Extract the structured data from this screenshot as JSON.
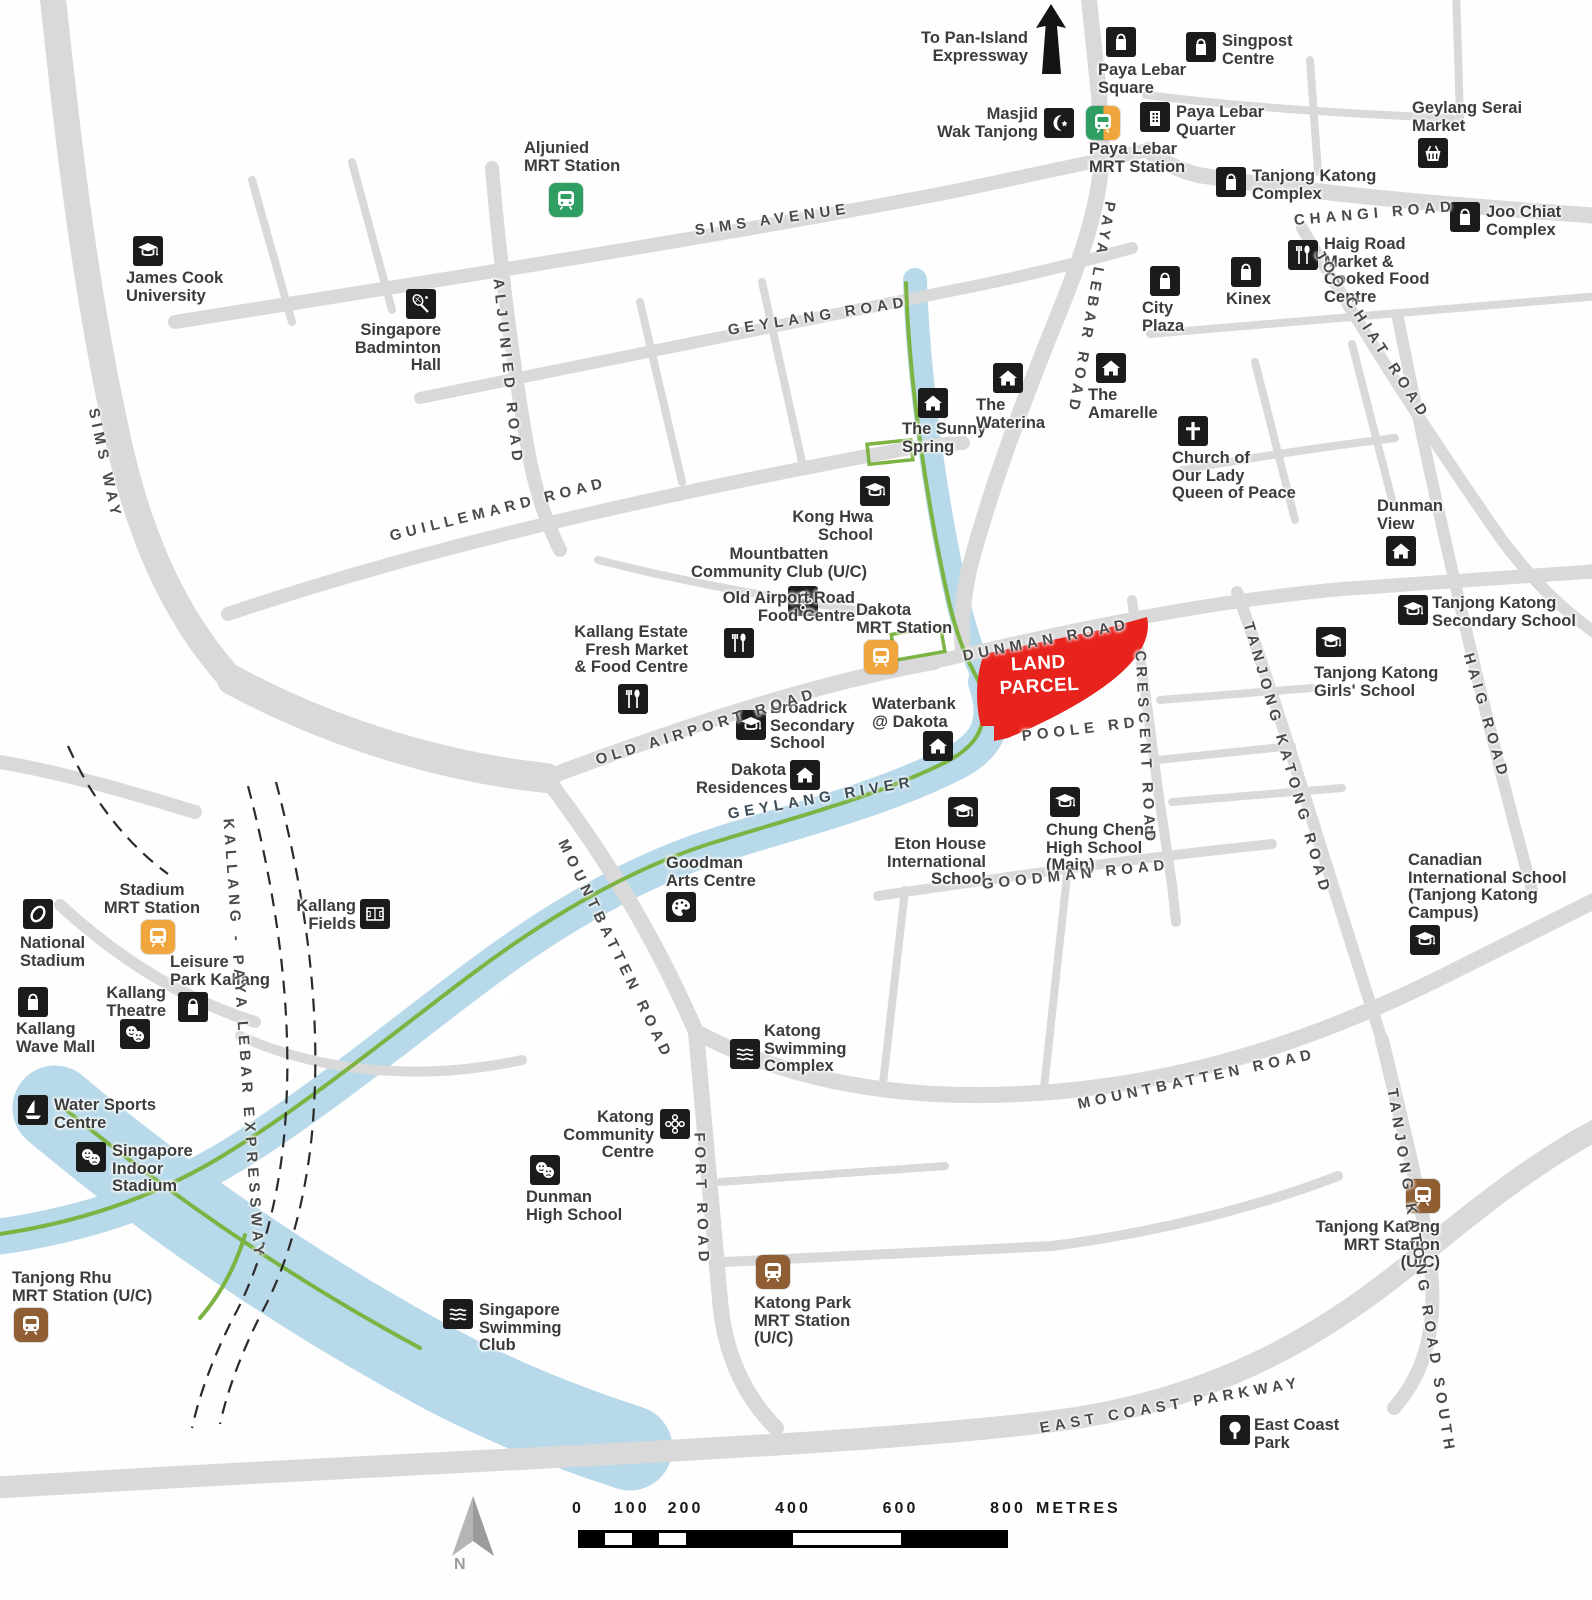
{
  "colors": {
    "road": "#d9d9d9",
    "water": "#b7d9e9",
    "park_connector": "#7cb342",
    "land_parcel": "#e8231d",
    "poi_icon_bg": "#1b1b1b",
    "mrt_yellow": "#f0a63c",
    "mrt_green": "#2f9e62",
    "mrt_brown": "#8f5f33",
    "text": "#3c3c3c"
  },
  "land_parcel": {
    "label": "LAND\nPARCEL"
  },
  "top_note": {
    "label": "To Pan-Island\nExpressway"
  },
  "compass": {
    "label": "N"
  },
  "scale_bar": {
    "ticks": [
      "0",
      "100",
      "200",
      "400",
      "600",
      "800"
    ],
    "metres": [
      0,
      100,
      200,
      400,
      600,
      800
    ],
    "unit": "METRES",
    "max": 800
  },
  "river_label": "GEYLANG RIVER",
  "road_labels": [
    {
      "id": "sims-avenue",
      "t": "SIMS AVENUE",
      "x": 695,
      "y": 222,
      "r": -8
    },
    {
      "id": "geylang-road",
      "t": "GEYLANG ROAD",
      "x": 728,
      "y": 322,
      "r": -9
    },
    {
      "id": "guillemard-road",
      "t": "GUILLEMARD ROAD",
      "x": 390,
      "y": 528,
      "r": -14
    },
    {
      "id": "aljunied-road",
      "t": "ALJUNIED ROAD",
      "x": 498,
      "y": 270,
      "r": 84
    },
    {
      "id": "sims-way",
      "t": "SIMS WAY",
      "x": 93,
      "y": 400,
      "r": 78
    },
    {
      "id": "paya-lebar-road",
      "t": "PAYA LEBAR ROAD",
      "x": 1110,
      "y": 193,
      "r": 100
    },
    {
      "id": "changi-road",
      "t": "CHANGI ROAD",
      "x": 1294,
      "y": 212,
      "r": -5
    },
    {
      "id": "joo-chiat-road",
      "t": "JOO CHIAT ROAD",
      "x": 1318,
      "y": 243,
      "r": 57
    },
    {
      "id": "dunman-road",
      "t": "DUNMAN ROAD",
      "x": 963,
      "y": 648,
      "r": -11
    },
    {
      "id": "old-airport-road",
      "t": "OLD AIRPORT ROAD",
      "x": 596,
      "y": 752,
      "r": -17
    },
    {
      "id": "poole-rd",
      "t": "POOLE RD",
      "x": 1022,
      "y": 728,
      "r": -7
    },
    {
      "id": "crescent-road",
      "t": "CRESCENT ROAD",
      "x": 1140,
      "y": 642,
      "r": 87
    },
    {
      "id": "tanjong-katong-road",
      "t": "TANJONG KATONG ROAD",
      "x": 1248,
      "y": 614,
      "r": 74
    },
    {
      "id": "haig-road",
      "t": "HAIG ROAD",
      "x": 1468,
      "y": 645,
      "r": 74
    },
    {
      "id": "geylang-river",
      "t": "GEYLANG RIVER",
      "x": 728,
      "y": 806,
      "r": -10,
      "river": true
    },
    {
      "id": "goodman-road",
      "t": "GOODMAN ROAD",
      "x": 982,
      "y": 876,
      "r": -6
    },
    {
      "id": "mountbatten-road-upper",
      "t": "MOUNTBATTEN ROAD",
      "x": 562,
      "y": 832,
      "r": 64
    },
    {
      "id": "kallang-paya-lebar-expressway",
      "t": "KALLANG - PAYA LEBAR EXPRESSWAY",
      "x": 228,
      "y": 810,
      "r": 86
    },
    {
      "id": "fort-road",
      "t": "FORT ROAD",
      "x": 699,
      "y": 1124,
      "r": 88
    },
    {
      "id": "mountbatten-road-lower",
      "t": "MOUNTBATTEN ROAD",
      "x": 1078,
      "y": 1096,
      "r": -12
    },
    {
      "id": "tanjong-katong-road-south",
      "t": "TANJONG KATONG ROAD SOUTH",
      "x": 1392,
      "y": 1080,
      "r": 81
    },
    {
      "id": "east-coast-parkway",
      "t": "EAST COAST PARKWAY",
      "x": 1040,
      "y": 1420,
      "r": -10
    }
  ],
  "pois": [
    {
      "id": "paya-lebar-square",
      "icon": "bag",
      "t": "Paya Lebar\nSquare",
      "ix": 1106,
      "iy": 27,
      "lx": 1098,
      "ly": 62,
      "lw": 110,
      "la": "l"
    },
    {
      "id": "singpost-centre",
      "icon": "bag",
      "t": "Singpost\nCentre",
      "ix": 1186,
      "iy": 32,
      "lx": 1222,
      "ly": 33,
      "lw": 95,
      "la": "l"
    },
    {
      "id": "masjid-wak-tanjong",
      "icon": "crescent",
      "t": "Masjid\nWak Tanjong",
      "ix": 1044,
      "iy": 108,
      "lx": 926,
      "ly": 106,
      "lw": 112,
      "la": "r"
    },
    {
      "id": "paya-lebar-mrt-station",
      "icon": "mrt",
      "c": "interchange",
      "t": "Paya Lebar\nMRT Station",
      "ix": 1086,
      "iy": 106,
      "lx": 1089,
      "ly": 141,
      "lw": 110,
      "la": "l"
    },
    {
      "id": "paya-lebar-quarter",
      "icon": "building",
      "t": "Paya Lebar\nQuarter",
      "ix": 1140,
      "iy": 102,
      "lx": 1176,
      "ly": 104,
      "lw": 100,
      "la": "l"
    },
    {
      "id": "geylang-serai-market",
      "icon": "basket",
      "t": "Geylang Serai\nMarket",
      "ix": 1418,
      "iy": 138,
      "lx": 1412,
      "ly": 100,
      "lw": 130,
      "la": "l"
    },
    {
      "id": "tanjong-katong-complex",
      "icon": "bag",
      "t": "Tanjong Katong\nComplex",
      "ix": 1216,
      "iy": 167,
      "lx": 1252,
      "ly": 168,
      "lw": 125,
      "la": "l"
    },
    {
      "id": "joo-chiat-complex",
      "icon": "bag",
      "t": "Joo Chiat\nComplex",
      "ix": 1450,
      "iy": 202,
      "lx": 1486,
      "ly": 204,
      "lw": 95,
      "la": "l"
    },
    {
      "id": "haig-road-market",
      "icon": "food",
      "t": "Haig Road\nMarket &\nCooked Food\nCentre",
      "ix": 1288,
      "iy": 240,
      "lx": 1324,
      "ly": 236,
      "lw": 120,
      "la": "l"
    },
    {
      "id": "city-plaza",
      "icon": "bag",
      "t": "City\nPlaza",
      "ix": 1150,
      "iy": 266,
      "lx": 1142,
      "ly": 300,
      "lw": 60,
      "la": "l"
    },
    {
      "id": "kinex",
      "icon": "bag",
      "t": "Kinex",
      "ix": 1231,
      "iy": 257,
      "lx": 1226,
      "ly": 291,
      "lw": 60,
      "la": "l"
    },
    {
      "id": "james-cook-university",
      "icon": "grad",
      "t": "James Cook\nUniversity",
      "ix": 133,
      "iy": 236,
      "lx": 126,
      "ly": 270,
      "lw": 110,
      "la": "l"
    },
    {
      "id": "singapore-badminton-hall",
      "icon": "racquet-bad",
      "t": "Singapore\nBadminton\nHall",
      "ix": 406,
      "iy": 289,
      "lx": 336,
      "ly": 322,
      "lw": 105,
      "la": "r"
    },
    {
      "id": "aljunied-mrt-station",
      "icon": "mrt",
      "c": "green",
      "t": "Aljunied\nMRT Station",
      "ix": 549,
      "iy": 183,
      "lx": 524,
      "ly": 140,
      "lw": 115,
      "la": "l"
    },
    {
      "id": "the-sunny-spring",
      "icon": "house",
      "t": "The Sunny\nSpring",
      "ix": 918,
      "iy": 388,
      "lx": 902,
      "ly": 421,
      "lw": 100,
      "la": "l"
    },
    {
      "id": "the-waterina",
      "icon": "house",
      "t": "The\nWaterina",
      "ix": 993,
      "iy": 363,
      "lx": 976,
      "ly": 397,
      "lw": 90,
      "la": "l"
    },
    {
      "id": "the-amarelle",
      "icon": "house",
      "t": "The\nAmarelle",
      "ix": 1096,
      "iy": 353,
      "lx": 1088,
      "ly": 387,
      "lw": 90,
      "la": "l"
    },
    {
      "id": "church-our-lady-queen-of-peace",
      "icon": "cross",
      "t": "Church of\nOur Lady\nQueen of Peace",
      "ix": 1178,
      "iy": 416,
      "lx": 1172,
      "ly": 450,
      "lw": 148,
      "la": "l"
    },
    {
      "id": "dunman-view",
      "icon": "house",
      "t": "Dunman\nView",
      "ix": 1386,
      "iy": 536,
      "lx": 1377,
      "ly": 498,
      "lw": 80,
      "la": "l"
    },
    {
      "id": "kong-hwa-school",
      "icon": "grad",
      "t": "Kong Hwa\nSchool",
      "ix": 860,
      "iy": 476,
      "lx": 776,
      "ly": 509,
      "lw": 97,
      "la": "r"
    },
    {
      "id": "mountbatten-community-club",
      "icon": "community",
      "t": "Mountbatten\nCommunity Club (U/C)",
      "ix": 788,
      "iy": 586,
      "lx": 660,
      "ly": 546,
      "lw": 238,
      "la": "c"
    },
    {
      "id": "old-airport-road-food-centre",
      "icon": "food",
      "t": "Old Airport Road\nFood Centre",
      "ix": 724,
      "iy": 628,
      "lx": 640,
      "ly": 590,
      "lw": 215,
      "la": "r"
    },
    {
      "id": "kallang-estate-market",
      "icon": "food",
      "t": "Kallang Estate\nFresh Market\n& Food Centre",
      "ix": 618,
      "iy": 684,
      "lx": 546,
      "ly": 624,
      "lw": 142,
      "la": "r"
    },
    {
      "id": "dakota-mrt-station",
      "icon": "mrt",
      "c": "yellow",
      "t": "Dakota\nMRT Station",
      "ix": 864,
      "iy": 640,
      "lx": 856,
      "ly": 602,
      "lw": 112,
      "la": "l"
    },
    {
      "id": "waterbank-at-dakota",
      "icon": "house",
      "t": "Waterbank\n@ Dakota",
      "ix": 923,
      "iy": 731,
      "lx": 872,
      "ly": 696,
      "lw": 100,
      "la": "l"
    },
    {
      "id": "broadrick-secondary-school",
      "icon": "grad",
      "t": "Broadrick\nSecondary\nSchool",
      "ix": 736,
      "iy": 710,
      "lx": 770,
      "ly": 700,
      "lw": 112,
      "la": "l"
    },
    {
      "id": "dakota-residences",
      "icon": "house",
      "t": "Dakota\nResidences",
      "ix": 790,
      "iy": 760,
      "lx": 696,
      "ly": 762,
      "lw": 90,
      "la": "r"
    },
    {
      "id": "eton-house-international-school",
      "icon": "grad",
      "t": "Eton House\nInternational\nSchool",
      "ix": 948,
      "iy": 797,
      "lx": 874,
      "ly": 836,
      "lw": 112,
      "la": "r"
    },
    {
      "id": "chung-cheng-high-school",
      "icon": "grad",
      "t": "Chung Cheng\nHigh School\n(Main)",
      "ix": 1050,
      "iy": 787,
      "lx": 1046,
      "ly": 822,
      "lw": 122,
      "la": "l"
    },
    {
      "id": "goodman-arts-centre",
      "icon": "palette",
      "t": "Goodman\nArts Centre",
      "ix": 666,
      "iy": 892,
      "lx": 666,
      "ly": 855,
      "lw": 112,
      "la": "l"
    },
    {
      "id": "kallang-fields",
      "icon": "field",
      "t": "Kallang\nFields",
      "ix": 360,
      "iy": 899,
      "lx": 294,
      "ly": 898,
      "lw": 62,
      "la": "r"
    },
    {
      "id": "stadium-mrt-station",
      "icon": "mrt",
      "c": "yellow",
      "t": "Stadium\nMRT Station",
      "ix": 141,
      "iy": 920,
      "lx": 88,
      "ly": 882,
      "lw": 128,
      "la": "c"
    },
    {
      "id": "national-stadium",
      "icon": "stadium",
      "t": "National\nStadium",
      "ix": 23,
      "iy": 899,
      "lx": 20,
      "ly": 935,
      "lw": 90,
      "la": "l"
    },
    {
      "id": "leisure-park-kallang",
      "icon": "bag",
      "t": "Leisure\nPark Kallang",
      "ix": 178,
      "iy": 992,
      "lx": 170,
      "ly": 954,
      "lw": 128,
      "la": "l"
    },
    {
      "id": "kallang-theatre",
      "icon": "masks",
      "t": "Kallang\nTheatre",
      "ix": 120,
      "iy": 1019,
      "lx": 90,
      "ly": 985,
      "lw": 76,
      "la": "r"
    },
    {
      "id": "kallang-wave-mall",
      "icon": "bag",
      "t": "Kallang\nWave Mall",
      "ix": 18,
      "iy": 987,
      "lx": 16,
      "ly": 1021,
      "lw": 95,
      "la": "l"
    },
    {
      "id": "water-sports-centre",
      "icon": "sail",
      "t": "Water Sports\nCentre",
      "ix": 18,
      "iy": 1095,
      "lx": 54,
      "ly": 1097,
      "lw": 105,
      "la": "l"
    },
    {
      "id": "singapore-indoor-stadium",
      "icon": "masks",
      "t": "Singapore\nIndoor\nStadium",
      "ix": 76,
      "iy": 1142,
      "lx": 112,
      "ly": 1143,
      "lw": 92,
      "la": "l"
    },
    {
      "id": "katong-swimming-complex",
      "icon": "waves",
      "t": "Katong\nSwimming\nComplex",
      "ix": 730,
      "iy": 1039,
      "lx": 764,
      "ly": 1023,
      "lw": 96,
      "la": "l"
    },
    {
      "id": "katong-community-centre",
      "icon": "community",
      "t": "Katong\nCommunity\nCentre",
      "ix": 660,
      "iy": 1109,
      "lx": 550,
      "ly": 1109,
      "lw": 104,
      "la": "r"
    },
    {
      "id": "dunman-high-school",
      "icon": "masks",
      "t": "Dunman\nHigh School",
      "ix": 530,
      "iy": 1155,
      "lx": 526,
      "ly": 1189,
      "lw": 112,
      "la": "l"
    },
    {
      "id": "katong-park-mrt-station",
      "icon": "mrt",
      "c": "brown",
      "t": "Katong Park\nMRT Station\n(U/C)",
      "ix": 756,
      "iy": 1255,
      "lx": 754,
      "ly": 1295,
      "lw": 112,
      "la": "l"
    },
    {
      "id": "singapore-swimming-club",
      "icon": "waves",
      "t": "Singapore\nSwimming\nClub",
      "ix": 443,
      "iy": 1299,
      "lx": 479,
      "ly": 1302,
      "lw": 102,
      "la": "l"
    },
    {
      "id": "tanjong-rhu-mrt-station",
      "icon": "mrt",
      "c": "brown",
      "t": "Tanjong Rhu\nMRT Station (U/C)",
      "ix": 14,
      "iy": 1308,
      "lx": 12,
      "ly": 1270,
      "lw": 152,
      "la": "l"
    },
    {
      "id": "canadian-international-school",
      "icon": "grad",
      "t": "Canadian\nInternational School\n(Tanjong Katong\nCampus)",
      "ix": 1410,
      "iy": 925,
      "lx": 1408,
      "ly": 852,
      "lw": 162,
      "la": "l"
    },
    {
      "id": "tanjong-katong-mrt-station",
      "icon": "mrt",
      "c": "brown",
      "t": "Tanjong Katong\nMRT Station\n(U/C)",
      "ix": 1406,
      "iy": 1179,
      "lx": 1314,
      "ly": 1219,
      "lw": 126,
      "la": "r"
    },
    {
      "id": "east-coast-park",
      "icon": "tree",
      "t": "East Coast\nPark",
      "ix": 1220,
      "iy": 1415,
      "lx": 1254,
      "ly": 1417,
      "lw": 88,
      "la": "l"
    },
    {
      "id": "tanjong-katong-secondary-school",
      "icon": "grad",
      "t": "Tanjong Katong\nSecondary School",
      "ix": 1398,
      "iy": 595,
      "lx": 1432,
      "ly": 595,
      "lw": 162,
      "la": "l"
    },
    {
      "id": "tanjong-katong-girls-school",
      "icon": "grad",
      "t": "Tanjong Katong\nGirls' School",
      "ix": 1316,
      "iy": 627,
      "lx": 1314,
      "ly": 665,
      "lw": 138,
      "la": "l"
    }
  ]
}
